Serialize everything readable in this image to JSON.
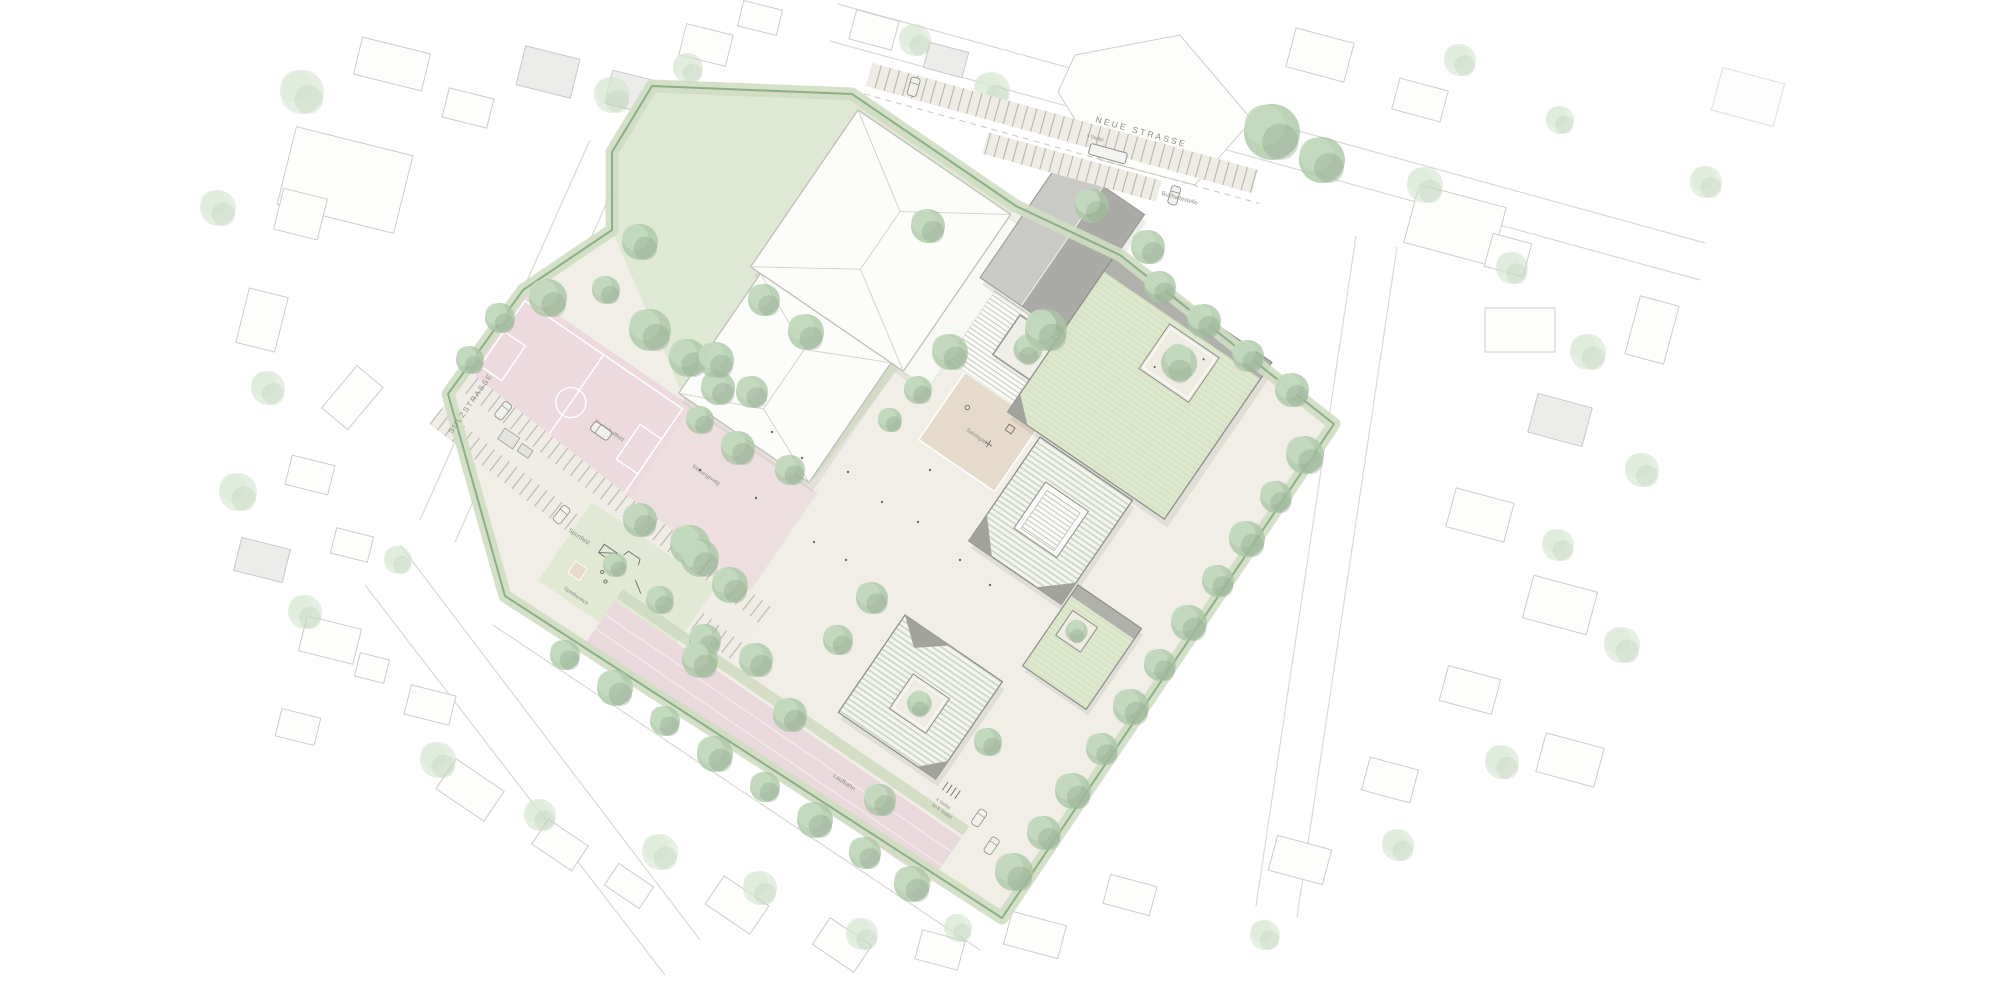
{
  "labels": {
    "street_top": "NEUE STRASSE",
    "street_left": "SULZSTRASSE",
    "bus_stop": "Bushaltestelle",
    "parking_count_top": "4 Stellpl.",
    "basketball_court": "Basketballfeld",
    "rescue_route": "Rettungsweg",
    "sports_field": "Sportfeld",
    "running_track": "Laufbahn",
    "sand_play": "Sandspiel",
    "play_area": "Spielbereich",
    "parking_count_bottom": "4 Stellpl.",
    "bike_parking": "B+R Stellpl."
  },
  "palette": {
    "site_hedge": "#7ea77b",
    "hedge_band": "#cfddc1",
    "ground": "#f0eee7",
    "lawn": "#dfe8d2",
    "roof_green": "#dee8cd",
    "roof_ribbed": "#f3f5ee",
    "court_pink": "#ecdade",
    "track_pink": "#ead9dc",
    "sand": "#e6dbcb",
    "building_white": "#fcfcfb",
    "building_gray": "#aaaaa6",
    "tree_green": "#a9c6a4",
    "label_gray": "#8c8c86"
  }
}
